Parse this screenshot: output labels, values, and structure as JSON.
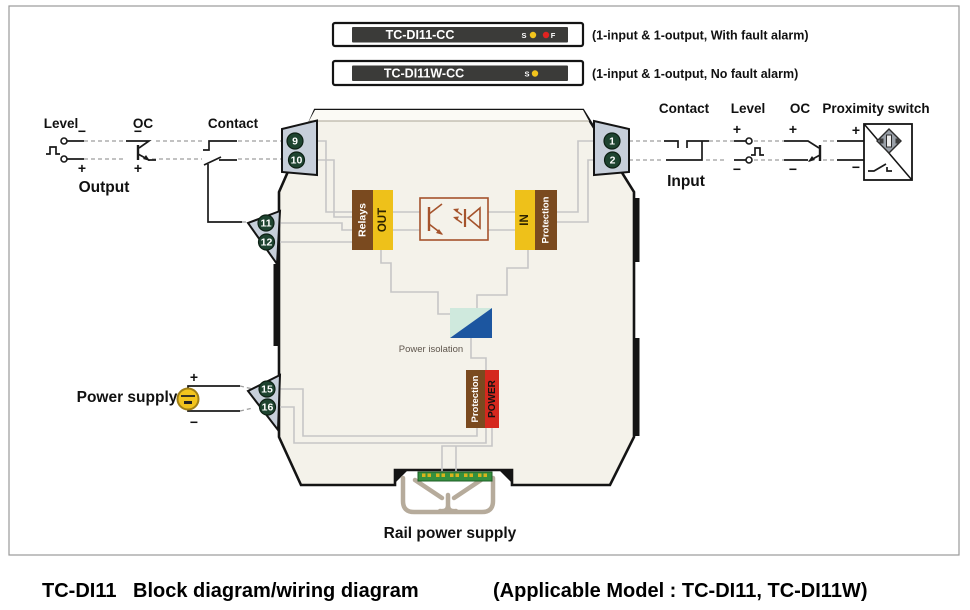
{
  "header": {
    "models": [
      {
        "name": "TC-DI11-CC",
        "led_s": "S",
        "led_f": "F",
        "desc": "(1-input & 1-output, With fault alarm)"
      },
      {
        "name": "TC-DI11W-CC",
        "led_s": "S",
        "desc": "(1-input & 1-output, No fault alarm)"
      }
    ]
  },
  "output_side": {
    "level": "Level",
    "oc": "OC",
    "contact": "Contact",
    "section": "Output",
    "power_supply": "Power supply"
  },
  "input_side": {
    "contact": "Contact",
    "level": "Level",
    "oc": "OC",
    "proximity": "Proximity switch",
    "section": "Input"
  },
  "signs": {
    "plus": "+",
    "minus": "−"
  },
  "terminals": {
    "output_top": [
      "9",
      "10"
    ],
    "output_mid": [
      "11",
      "12"
    ],
    "power": [
      "15",
      "16"
    ],
    "input": [
      "1",
      "2"
    ]
  },
  "module": {
    "relays": "Relays",
    "out": "OUT",
    "in": "IN",
    "protection_in": "Protection",
    "power_isolation": "Power isolation",
    "protection_power": "Protection",
    "power": "POWER",
    "rail": "Rail power supply"
  },
  "caption": {
    "model": "TC-DI11",
    "title": "Block diagram/wiring diagram",
    "applicable": "(Applicable Model : TC-DI11,  TC-DI11W)"
  },
  "colors": {
    "terminal_green": "#1e4430",
    "tab_gray": "#c7cfda",
    "relay_brown": "#7a4a1f",
    "block_yellow": "#eec11a",
    "power_red": "#d5281e",
    "iso_mint": "#cfe9dd",
    "iso_blue": "#1c56a0",
    "led_yellow": "#f2c41d",
    "led_red": "#e02321",
    "opto_outline": "#a5532c",
    "pcb_green": "#35903e",
    "module_body": "#f4f2ea"
  }
}
